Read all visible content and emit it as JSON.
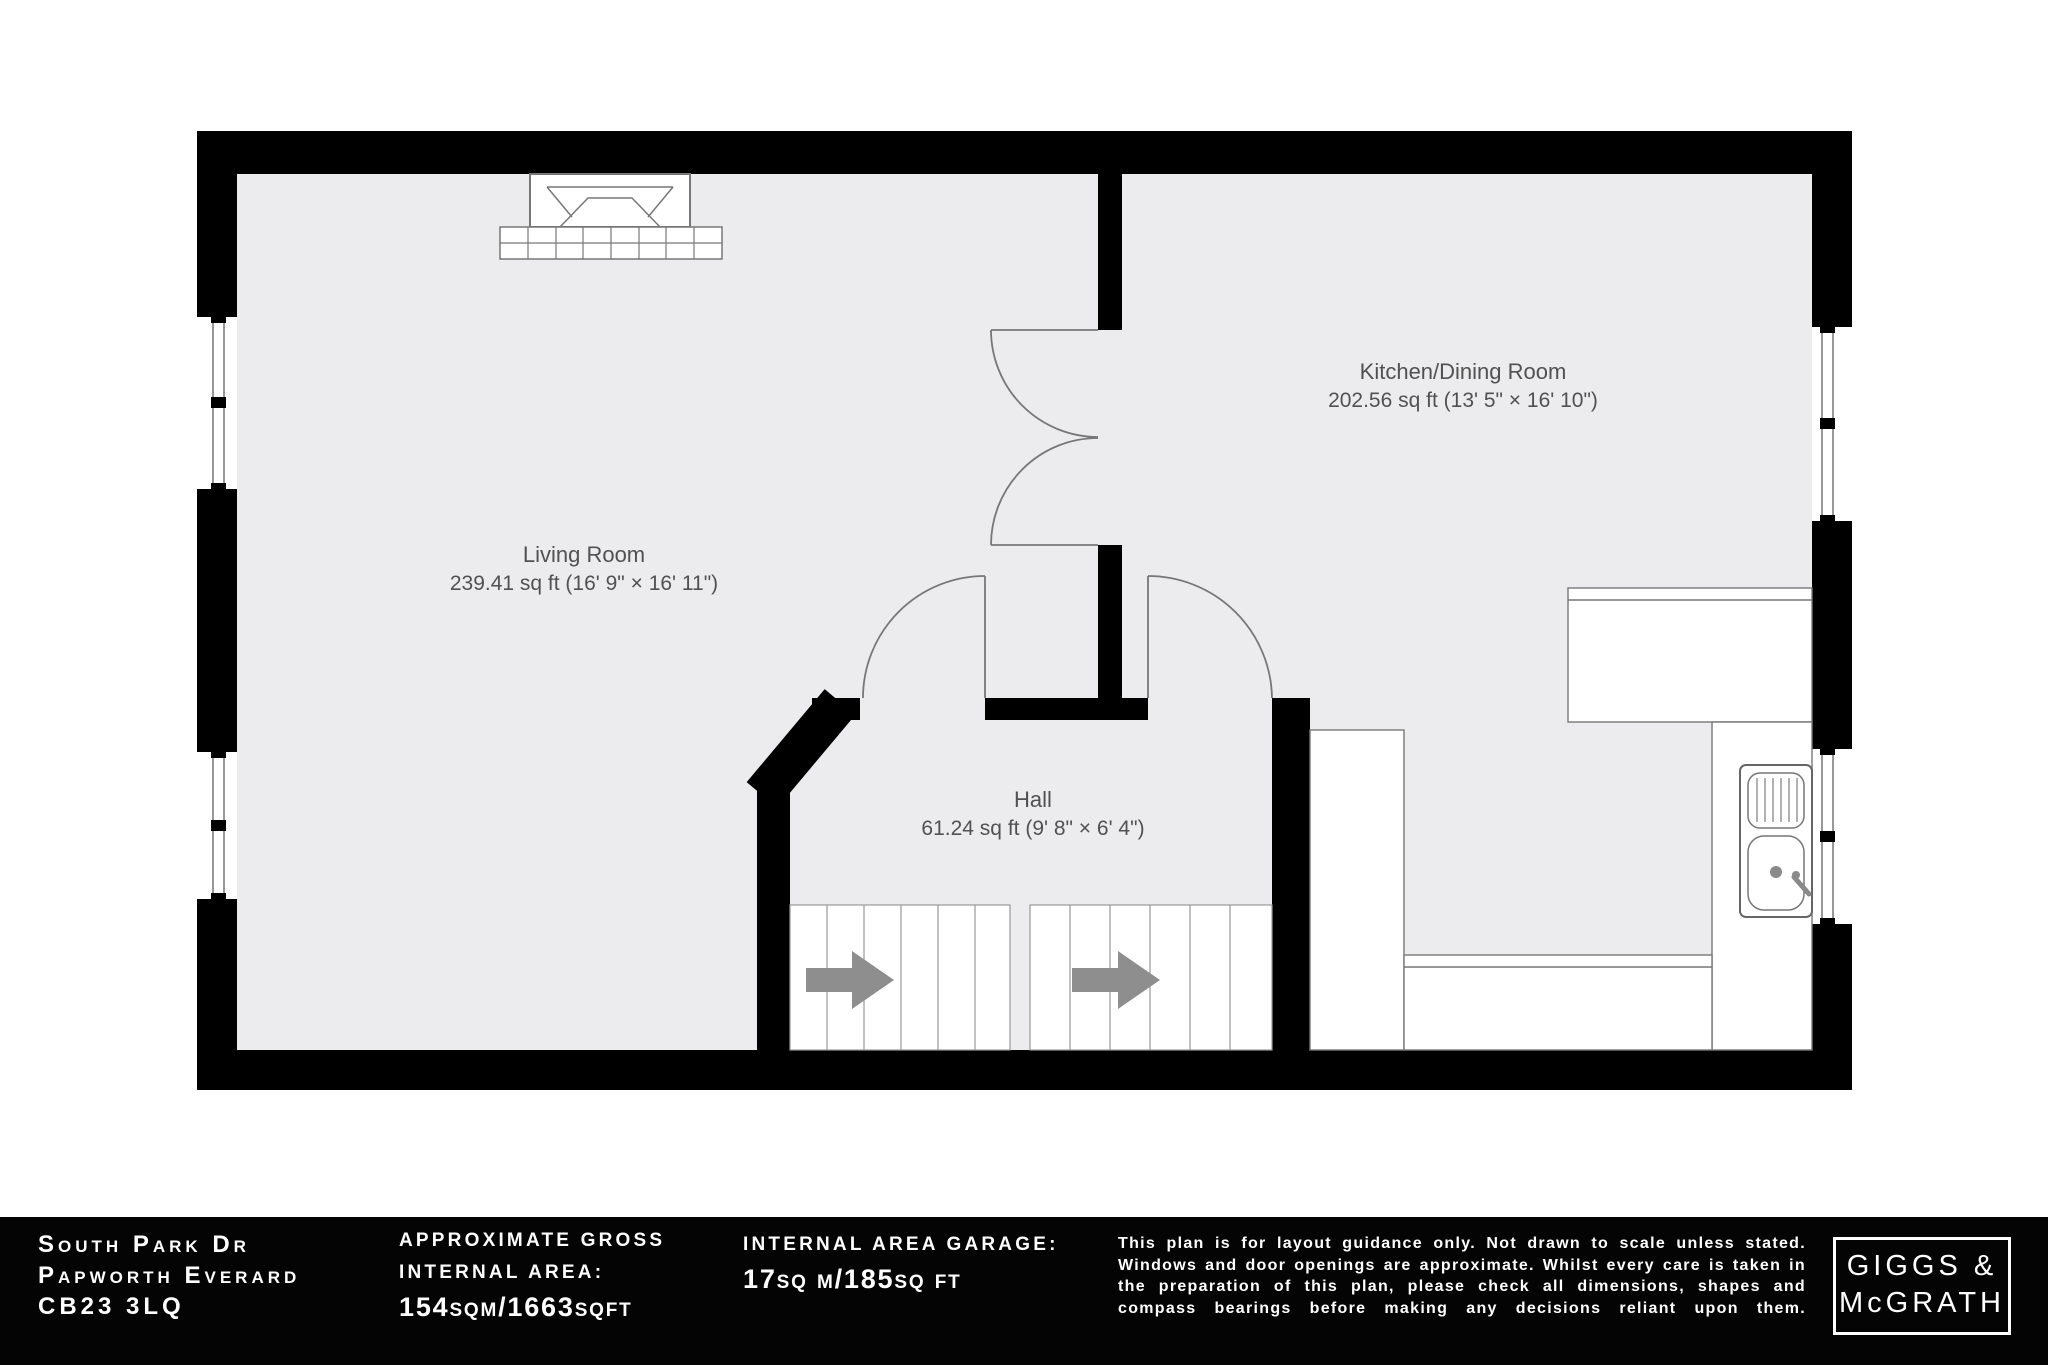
{
  "plan": {
    "rooms": {
      "living": {
        "name": "Living Room",
        "dims": "239.41 sq ft (16' 9\" × 16' 11\")"
      },
      "kitchen": {
        "name": "Kitchen/Dining Room",
        "dims": "202.56 sq ft (13' 5\" × 16' 10\")"
      },
      "hall": {
        "name": "Hall",
        "dims": "61.24 sq ft (9' 8\" × 6' 4\")"
      }
    },
    "icons": [
      "fireplace-icon",
      "sink-icon",
      "stair-arrow-icon",
      "door-swing-icon",
      "window-icon"
    ],
    "colors": {
      "wall": "#000000",
      "floor": "#ececee",
      "fixture_line": "#777777",
      "label_text": "#515151",
      "arrow": "#8e8e8e"
    }
  },
  "footer": {
    "colors": {
      "background": "#040404",
      "text": "#ffffff"
    },
    "address": {
      "line1": "South Park Dr",
      "line2": "Papworth Everard",
      "line3": "CB23 3LQ"
    },
    "gross_area": {
      "label_line1": "APPROXIMATE GROSS",
      "label_line2": "INTERNAL AREA:",
      "value": "154sqm/1663sqft"
    },
    "garage_area": {
      "label": "INTERNAL AREA GARAGE:",
      "value": "17sq m/185sq ft"
    },
    "disclaimer": "This plan is for layout guidance only. Not drawn to scale unless stated. Windows and door openings are approximate. Whilst every care is taken in the preparation of this plan, please check all dimensions, shapes and compass bearings before making any decisions reliant upon them.",
    "logo": {
      "line1": "GIGGS &",
      "line2": "McGRATH"
    }
  }
}
